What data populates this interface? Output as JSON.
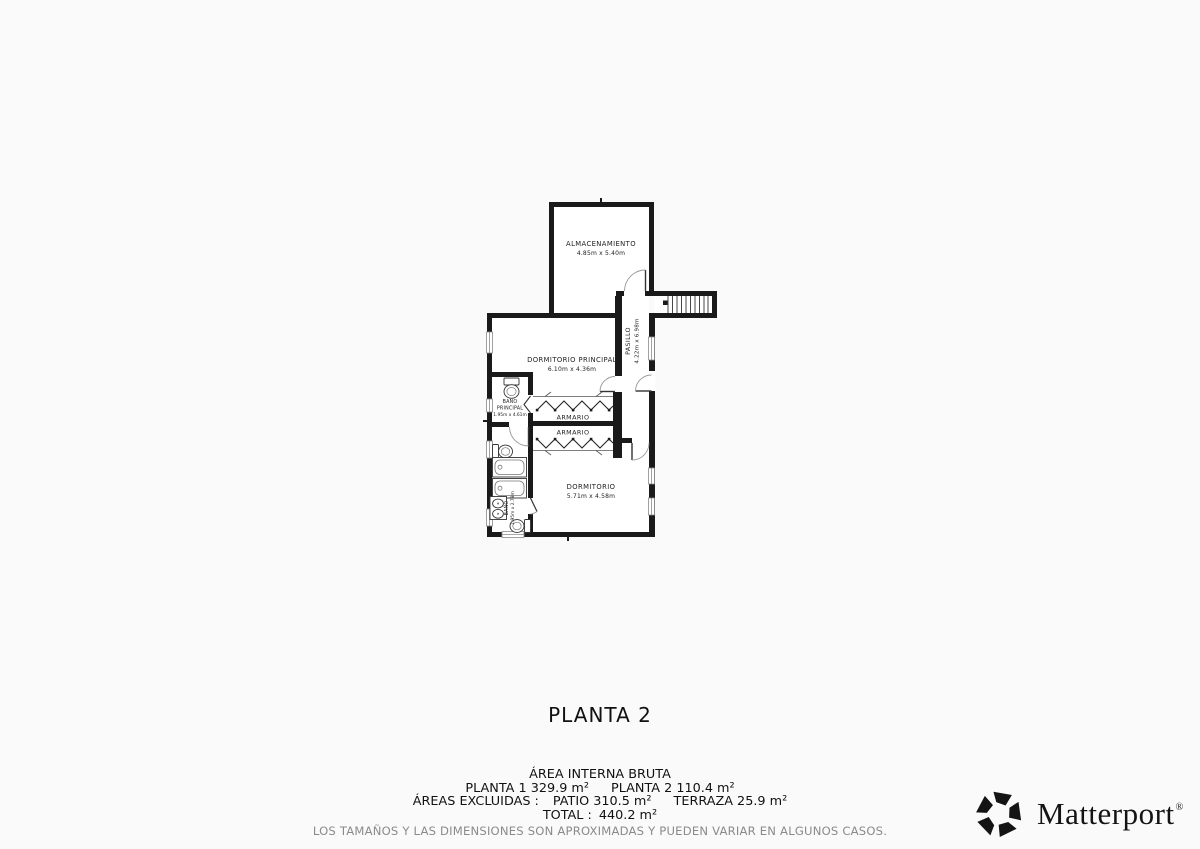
{
  "colors": {
    "background": "#fafafa",
    "room_interior": "#ffffff",
    "walls": "#1a1a1a",
    "labels": "#222222",
    "disclaimer_text": "#8a8a8a",
    "logo": "#141414"
  },
  "plan": {
    "title": "PLANTA 2",
    "rooms": {
      "almacenamiento": {
        "name": "ALMACENAMIENTO",
        "dims": "4.85m x 5.40m"
      },
      "pasillo": {
        "name": "PASILLO",
        "dims": "4.22m x 6.98m"
      },
      "dormitorio_principal": {
        "name": "DORMITORIO PRINCIPAL",
        "dims": "6.10m x 4.36m"
      },
      "bano_principal": {
        "name_line1": "BAÑO",
        "name_line2": "PRINCIPAL",
        "dims": "1.95m x 4.61m"
      },
      "armario_superior": {
        "name": "ARMARIO"
      },
      "armario_inferior": {
        "name": "ARMARIO"
      },
      "dormitorio": {
        "name": "DORMITORIO",
        "dims": "5.71m x 4.58m"
      },
      "bano": {
        "name": "BAÑO",
        "dims": "1.95m x 2.78m"
      }
    },
    "features": [
      "stairs",
      "doors",
      "windows",
      "closet-rails",
      "toilets",
      "bathtubs",
      "double-sink"
    ]
  },
  "summary": {
    "heading": "ÁREA INTERNA BRUTA",
    "planta1": "PLANTA 1 329.9 m²",
    "planta2": "PLANTA 2 110.4 m²",
    "excluidas_label": "ÁREAS EXCLUIDAS :",
    "patio": "PATIO 310.5 m²",
    "terraza": "TERRAZA 25.9 m²",
    "total_label": "TOTAL :",
    "total_value": "440.2 m²",
    "disclaimer": "LOS TAMAÑOS Y LAS DIMENSIONES SON APROXIMADAS Y PUEDEN VARIAR EN ALGUNOS CASOS."
  },
  "branding": {
    "name": "Matterport",
    "registered": "®"
  }
}
